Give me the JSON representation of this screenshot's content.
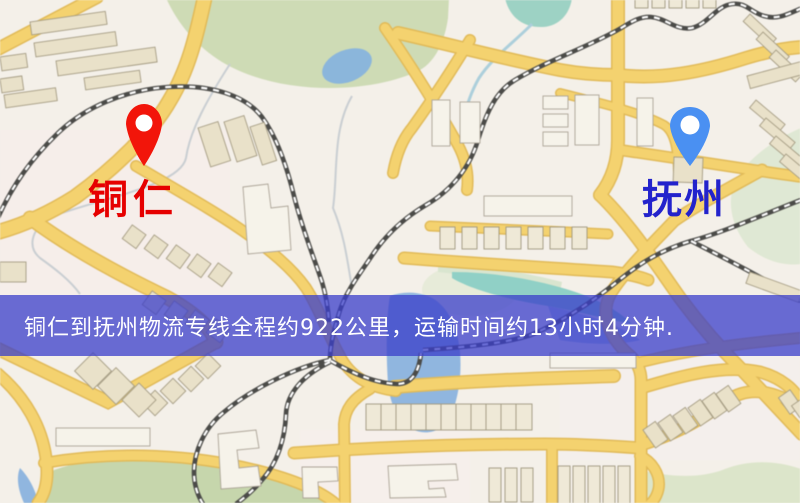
{
  "markers": {
    "origin": {
      "label": "铜仁",
      "pin_color": "#f2150a",
      "label_style": "color:#e60000"
    },
    "destination": {
      "label": "抚州",
      "pin_color": "#4a90f2",
      "label_style": "color:#2323cc"
    }
  },
  "banner": {
    "text": "铜仁到抚州物流专线全程约922公里，运输时间约13小时4分钟.",
    "style": "background:rgba(58,62,202,0.75);color:#ffffff"
  },
  "route": {
    "origin": "铜仁",
    "destination": "抚州",
    "distance_km": 922,
    "duration_hours": 13,
    "duration_minutes": 4
  }
}
